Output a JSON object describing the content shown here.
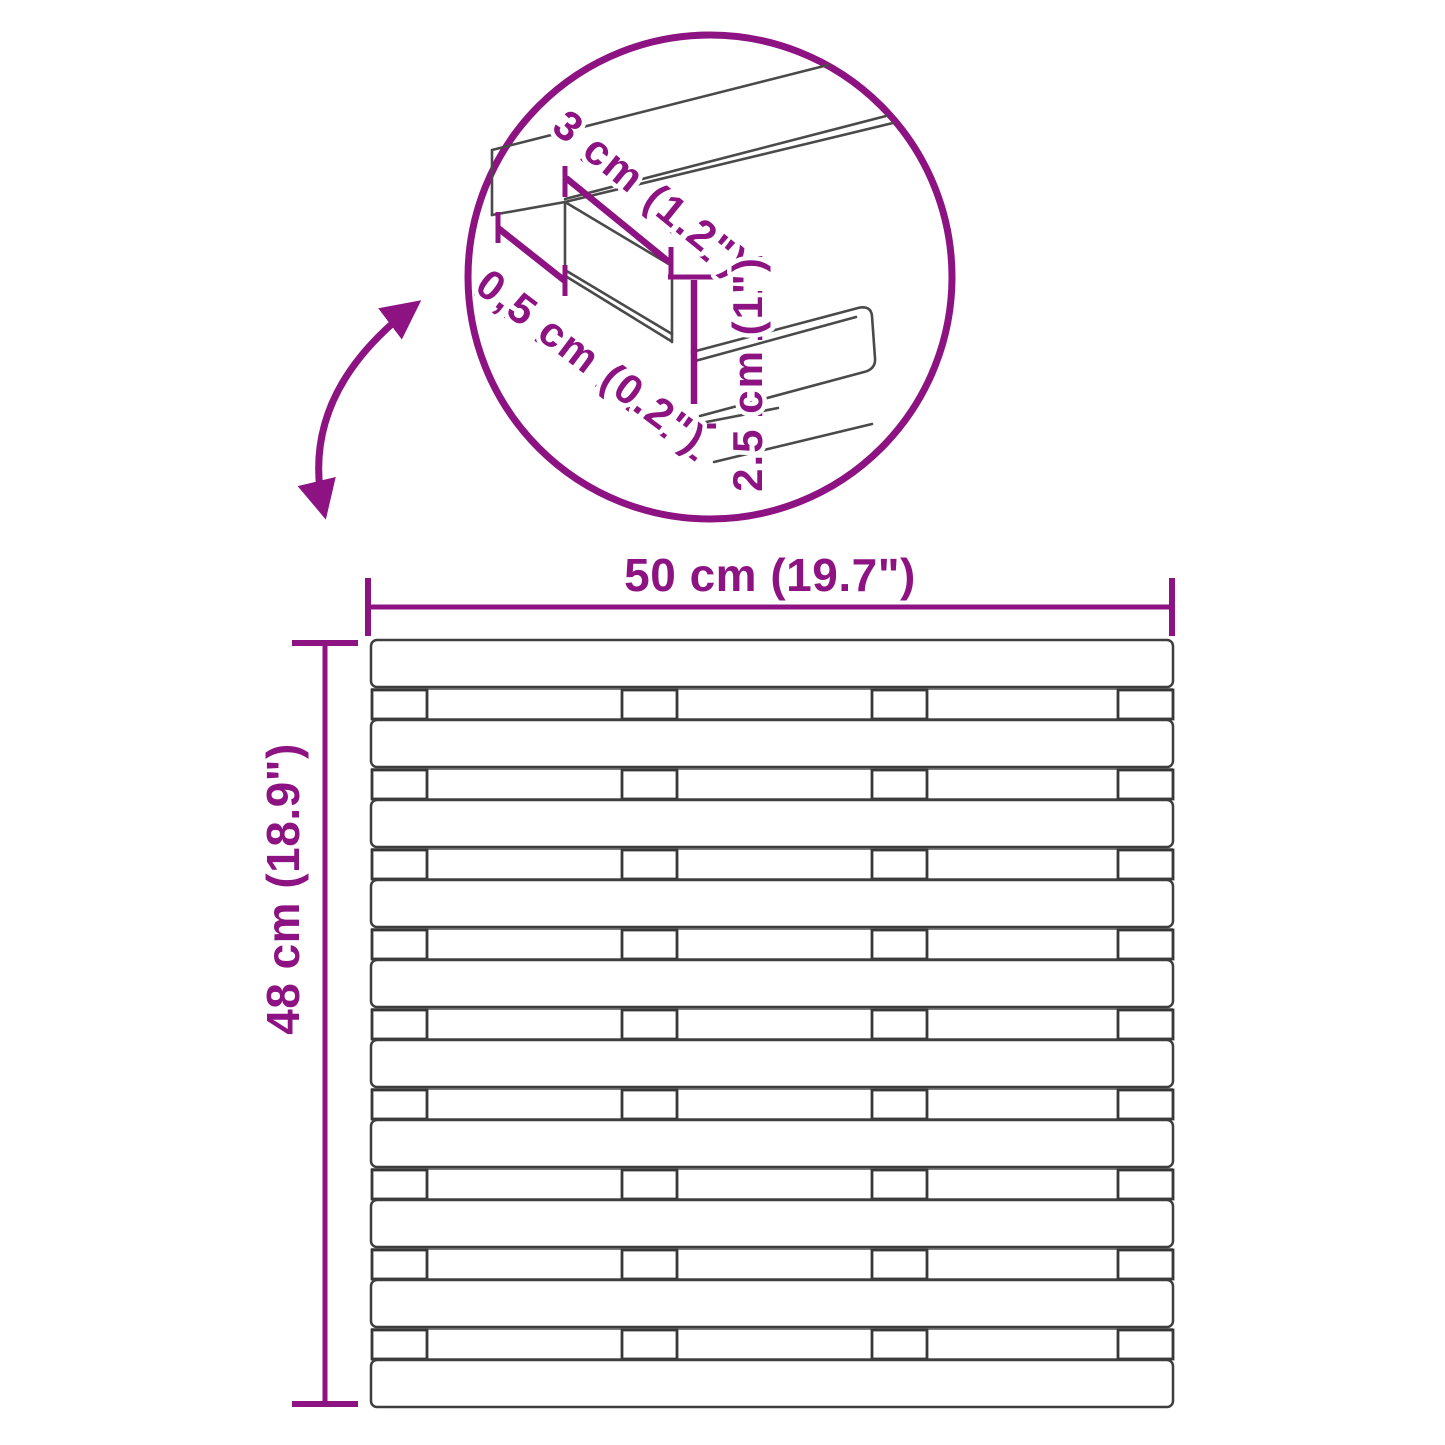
{
  "diagram_type": "product-dimension-diagram",
  "colors": {
    "accent_purple": "#8D1383",
    "line_dark": "#4a4a4a",
    "background": "#ffffff"
  },
  "inset_detail": {
    "slat_width_label": "3 cm (1.2\")",
    "slat_gap_label": "0,5 cm (0.2\")",
    "slat_height_label": "2.5 cm (1\")"
  },
  "overall": {
    "width_label": "50 cm (19.7\")",
    "height_label": "48 cm (18.9\")"
  },
  "figure": {
    "slat_rows": 10,
    "gap_rows": 9,
    "blocks_per_gap": 4
  }
}
